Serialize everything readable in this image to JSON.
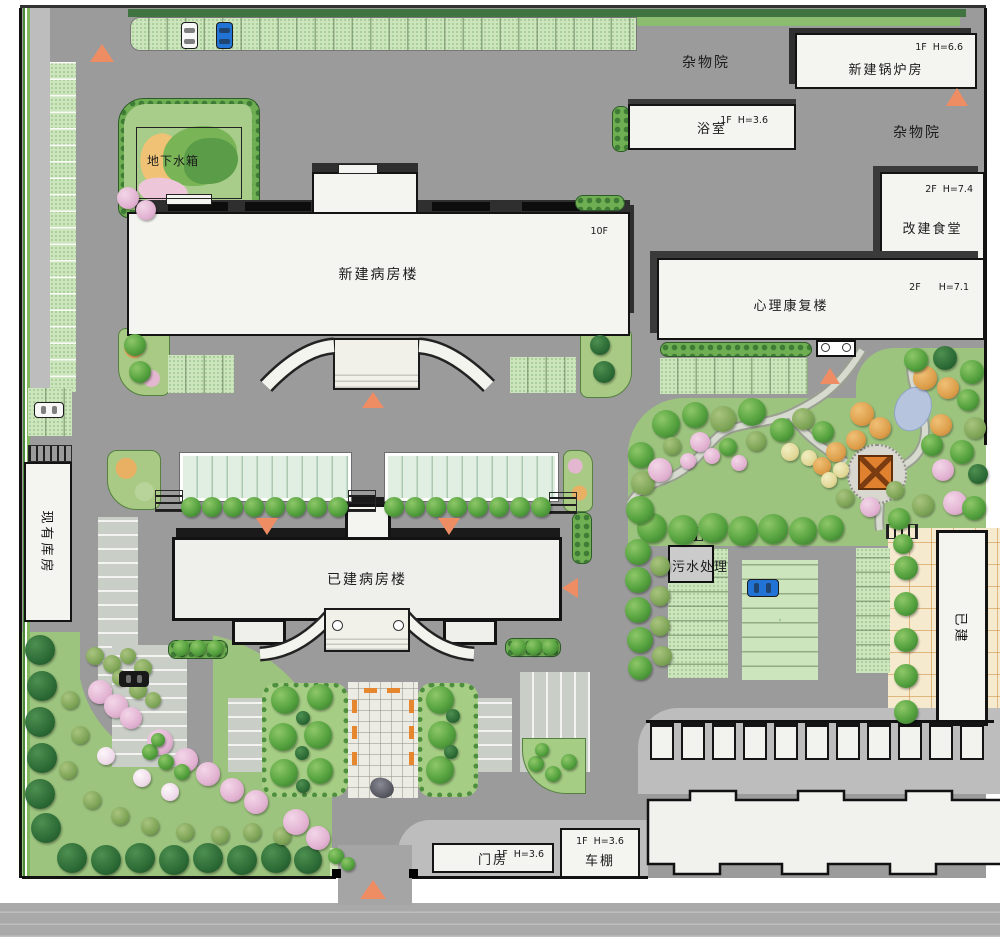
{
  "plan": {
    "buildings": {
      "new_ward": {
        "name": "新建病房楼",
        "floors": "10F"
      },
      "existing_ward": {
        "name": "已建病房楼"
      },
      "rehab": {
        "name": "心理康复楼",
        "spec": "2F      H=7.1"
      },
      "canteen": {
        "name": "改建食堂",
        "spec": "2F  H=7.4"
      },
      "boiler": {
        "name": "新建锅炉房",
        "spec": "1F  H=6.6"
      },
      "bathhouse": {
        "name": "浴室",
        "spec": "1F  H=3.6"
      },
      "gatehouse": {
        "name": "门房",
        "spec": "1F  H=3.6"
      },
      "carport": {
        "name": "车棚",
        "spec": "1F  H=3.6"
      },
      "warehouse": {
        "name": "现有库房"
      },
      "built_building": {
        "name": "已建"
      }
    },
    "areas": {
      "water_tank": "地下水箱",
      "sewage": "污水处理",
      "misc_yard_north": "杂物院",
      "misc_yard_east": "杂物院"
    },
    "colors": {
      "road": "#9b9b9b",
      "building_fill": "#f4f4f0",
      "outline": "#141414",
      "lawn": "#9cc47e",
      "parking_grid": "#cde5bd",
      "hedge": "#3f7d36",
      "marker_orange": "#ee8d63",
      "tan_paving": "#f5e9ce",
      "pond": "#b6c4de",
      "gazebo": "#e0812f"
    }
  }
}
